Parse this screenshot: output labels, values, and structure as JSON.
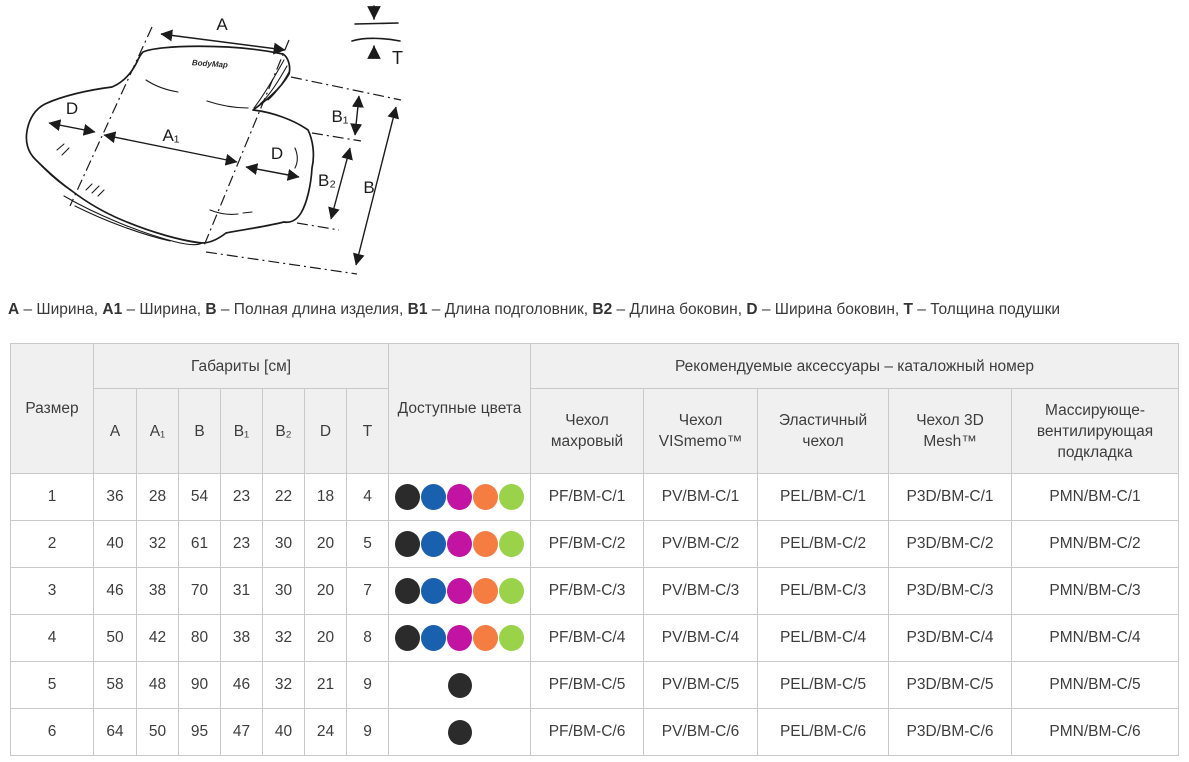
{
  "diagram": {
    "logo": "BodyMap",
    "labels": {
      "a": "A",
      "a1": "A₁",
      "b": "B",
      "b1": "B₁",
      "b2": "B₂",
      "d": "D",
      "t": "T"
    }
  },
  "legend": {
    "items": [
      {
        "term": "A",
        "desc": "Ширина"
      },
      {
        "term": "A1",
        "desc": "Ширина"
      },
      {
        "term": "B",
        "desc": "Полная длина изделия"
      },
      {
        "term": "B1",
        "desc": "Длина подголовник"
      },
      {
        "term": "B2",
        "desc": "Длина боковин"
      },
      {
        "term": "D",
        "desc": "Ширина боковин"
      },
      {
        "term": "T",
        "desc": "Толщина подушки"
      }
    ],
    "separator": " – ",
    "joiner": ", "
  },
  "table": {
    "header": {
      "size": "Размер",
      "dimensions_group": "Габариты [см]",
      "dimension_cols": [
        "A",
        "A₁",
        "B",
        "B₁",
        "B₂",
        "D",
        "T"
      ],
      "colors": "Доступные цвета",
      "accessories_group": "Рекомендуемые аксессуары – каталожный номер",
      "accessory_cols": [
        "Чехол махровый",
        "Чехол VISmemo™",
        "Эластичный чехол",
        "Чехол 3D Mesh™",
        "Массирующе-вентилирующая подкладка"
      ]
    },
    "color_palette": {
      "black": "#2b2b2b",
      "blue": "#1961ae",
      "magenta": "#c313a3",
      "orange": "#f67d42",
      "green": "#9ad34a"
    },
    "rows": [
      {
        "size": "1",
        "dims": [
          "36",
          "28",
          "54",
          "23",
          "22",
          "18",
          "4"
        ],
        "colors": [
          "black",
          "blue",
          "magenta",
          "orange",
          "green"
        ],
        "accessories": [
          "PF/BM-C/1",
          "PV/BM-C/1",
          "PEL/BM-C/1",
          "P3D/BM-C/1",
          "PMN/BM-C/1"
        ]
      },
      {
        "size": "2",
        "dims": [
          "40",
          "32",
          "61",
          "23",
          "30",
          "20",
          "5"
        ],
        "colors": [
          "black",
          "blue",
          "magenta",
          "orange",
          "green"
        ],
        "accessories": [
          "PF/BM-C/2",
          "PV/BM-C/2",
          "PEL/BM-C/2",
          "P3D/BM-C/2",
          "PMN/BM-C/2"
        ]
      },
      {
        "size": "3",
        "dims": [
          "46",
          "38",
          "70",
          "31",
          "30",
          "20",
          "7"
        ],
        "colors": [
          "black",
          "blue",
          "magenta",
          "orange",
          "green"
        ],
        "accessories": [
          "PF/BM-C/3",
          "PV/BM-C/3",
          "PEL/BM-C/3",
          "P3D/BM-C/3",
          "PMN/BM-C/3"
        ]
      },
      {
        "size": "4",
        "dims": [
          "50",
          "42",
          "80",
          "38",
          "32",
          "20",
          "8"
        ],
        "colors": [
          "black",
          "blue",
          "magenta",
          "orange",
          "green"
        ],
        "accessories": [
          "PF/BM-C/4",
          "PV/BM-C/4",
          "PEL/BM-C/4",
          "P3D/BM-C/4",
          "PMN/BM-C/4"
        ]
      },
      {
        "size": "5",
        "dims": [
          "58",
          "48",
          "90",
          "46",
          "32",
          "21",
          "9"
        ],
        "colors": [
          "black"
        ],
        "accessories": [
          "PF/BM-C/5",
          "PV/BM-C/5",
          "PEL/BM-C/5",
          "P3D/BM-C/5",
          "PMN/BM-C/5"
        ]
      },
      {
        "size": "6",
        "dims": [
          "64",
          "50",
          "95",
          "47",
          "40",
          "24",
          "9"
        ],
        "colors": [
          "black"
        ],
        "accessories": [
          "PF/BM-C/6",
          "PV/BM-C/6",
          "PEL/BM-C/6",
          "P3D/BM-C/6",
          "PMN/BM-C/6"
        ]
      }
    ]
  }
}
